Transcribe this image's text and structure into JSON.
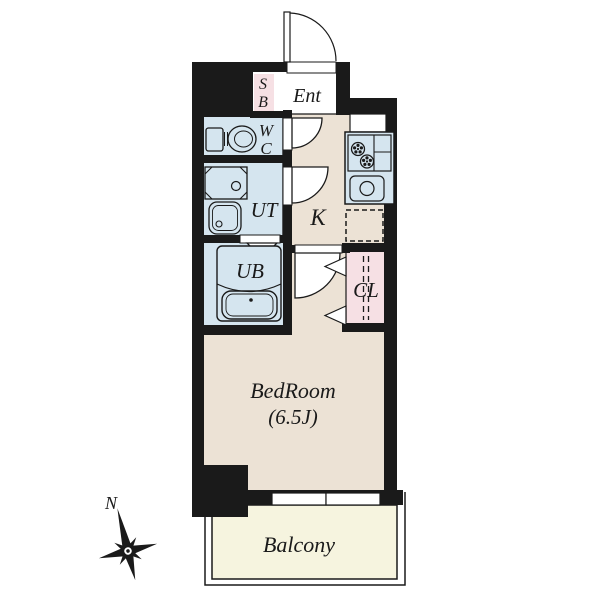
{
  "floorplan": {
    "rooms": {
      "entrance": {
        "label": "Ent"
      },
      "shoe_box": {
        "line1": "S",
        "line2": "B"
      },
      "toilet": {
        "line1": "W",
        "line2": "C"
      },
      "utility": {
        "label": "UT"
      },
      "kitchen": {
        "label": "K"
      },
      "unit_bath": {
        "label": "UB"
      },
      "closet": {
        "label": "CL"
      },
      "bedroom": {
        "name": "BedRoom",
        "size": "(6.5J)"
      },
      "balcony": {
        "label": "Balcony"
      }
    },
    "compass": {
      "north_label": "N"
    },
    "colors": {
      "wall": "#1a1a1a",
      "floor_beige": "#ece2d5",
      "wet_area_blue": "#d5e5ef",
      "storage_pink": "#f6e0e4",
      "balcony_yellow": "#f6f4df",
      "paper_white": "#ffffff"
    }
  }
}
